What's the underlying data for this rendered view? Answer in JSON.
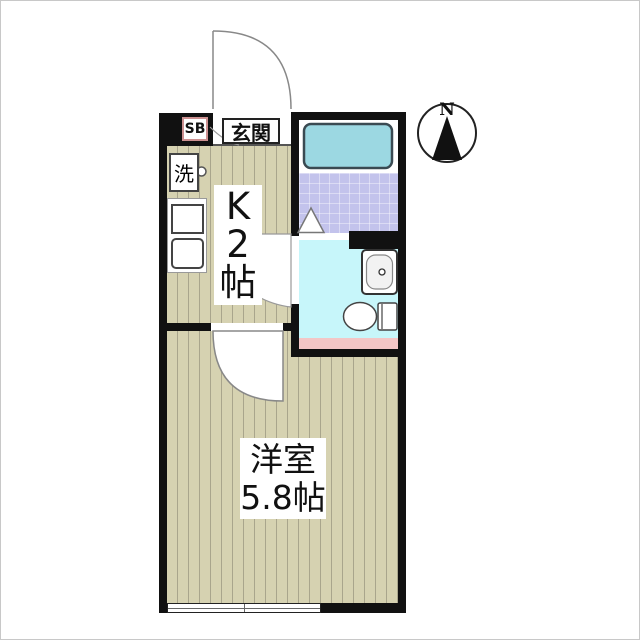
{
  "plan": {
    "entrance": {
      "label": "玄関",
      "shoe_box": "SB"
    },
    "kitchen": {
      "label_lines": [
        "K",
        "2",
        "帖"
      ],
      "washer": "洗"
    },
    "room": {
      "name": "洋室",
      "size": "5.8帖"
    },
    "compass": {
      "north": "N"
    },
    "colors": {
      "wall": "#111111",
      "flooring": "#d6d2b1",
      "flooring_stripe": "#a9a58c",
      "bathtub": "#9cd8e2",
      "shower_floor": "#c3c3ec",
      "washroom_floor": "#c7f6fa",
      "washroom_mat": "#f3c6c6",
      "shoe_box_border": "#cc9090"
    }
  }
}
